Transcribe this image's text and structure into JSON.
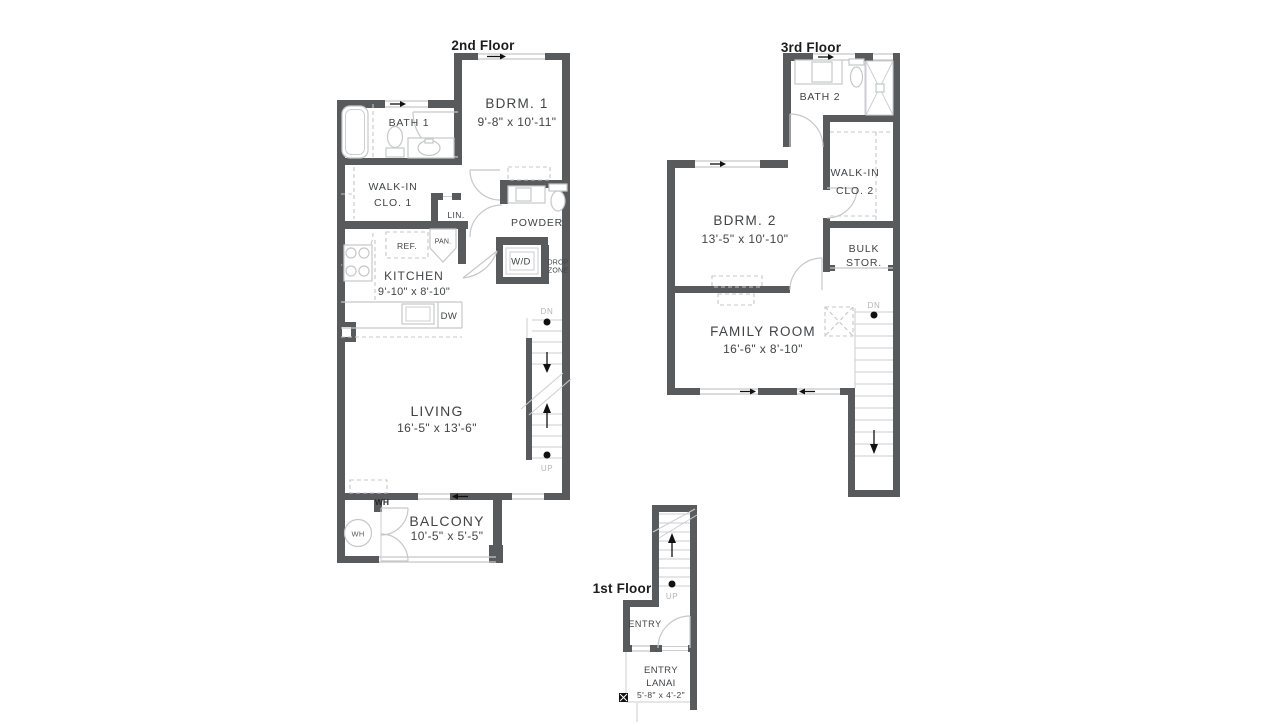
{
  "meta": {
    "type": "floor-plan",
    "units": "feet-inches"
  },
  "colors": {
    "wall": "#595a5c",
    "line": "#c6c7c8",
    "text": "#414345",
    "muted": "#b4b5b7",
    "title": "#1c1c1c",
    "marker": "#111111"
  },
  "floor2": {
    "title": "2nd Floor",
    "bath1": "BATH 1",
    "bdrm1": {
      "name": "BDRM. 1",
      "dims": "9'-8\" x 10'-11\""
    },
    "walkin1": {
      "line1": "WALK-IN",
      "line2": "CLO. 1"
    },
    "lin": "LIN.",
    "powder": "POWDER",
    "ref": "REF.",
    "pan": "PAN.",
    "kitchen": {
      "name": "KITCHEN",
      "dims": "9'-10\" x 8'-10\""
    },
    "dw": "DW",
    "wd": "W/D",
    "drop": {
      "line1": "DROP",
      "line2": "ZONE"
    },
    "living": {
      "name": "LIVING",
      "dims": "16'-5\" x 13'-6\""
    },
    "balcony": {
      "name": "BALCONY",
      "dims": "10'-5\" x 5'-5\""
    },
    "wh_closet": "WH",
    "wh_tank": "WH",
    "dn": "DN",
    "up": "UP"
  },
  "floor3": {
    "title": "3rd Floor",
    "bath2": "BATH 2",
    "walkin2": {
      "line1": "WALK-IN",
      "line2": "CLO. 2"
    },
    "bdrm2": {
      "name": "BDRM. 2",
      "dims": "13'-5\" x 10'-10\""
    },
    "bulk": {
      "line1": "BULK",
      "line2": "STOR."
    },
    "family": {
      "name": "FAMILY ROOM",
      "dims": "16'-6\" x 8'-10\""
    },
    "dn": "DN"
  },
  "floor1": {
    "title": "1st Floor",
    "entry": "ENTRY",
    "lanai": {
      "line1": "ENTRY",
      "line2": "LANAI",
      "dims": "5'-8\" x 4'-2\""
    },
    "up": "UP"
  }
}
